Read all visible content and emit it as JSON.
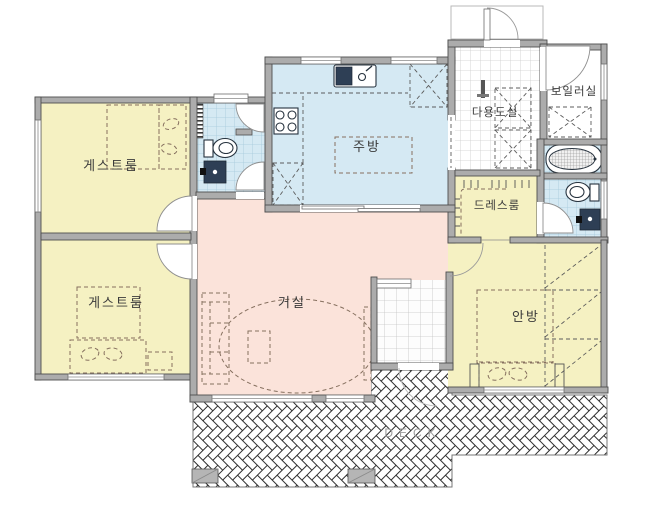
{
  "rooms": {
    "guest_room_top": {
      "label": "게스트룸"
    },
    "guest_room_bottom": {
      "label": "게스트룸"
    },
    "kitchen": {
      "label": "주방"
    },
    "living_room": {
      "label": "거실"
    },
    "utility_room": {
      "label": "다용도실"
    },
    "boiler_room": {
      "label": "보일러실"
    },
    "dress_room": {
      "label": "드레스룸"
    },
    "master_bedroom": {
      "label": "안방"
    },
    "deck": {
      "label": "DECK"
    }
  },
  "colors": {
    "bedroom_fill": "#f5f1c2",
    "wet_area_fill": "#d5e9f3",
    "living_fill": "#fbe3da",
    "plain_white": "#ffffff",
    "wall_fill": "#acacac",
    "wall_edge": "#4e4e4e",
    "deck_line": "#2e2e2e",
    "furniture_line": "#86705f",
    "fixture_dark": "#2e3f55",
    "label_color": "#3a3a3a",
    "deck_label_color": "#9c9c9c"
  }
}
